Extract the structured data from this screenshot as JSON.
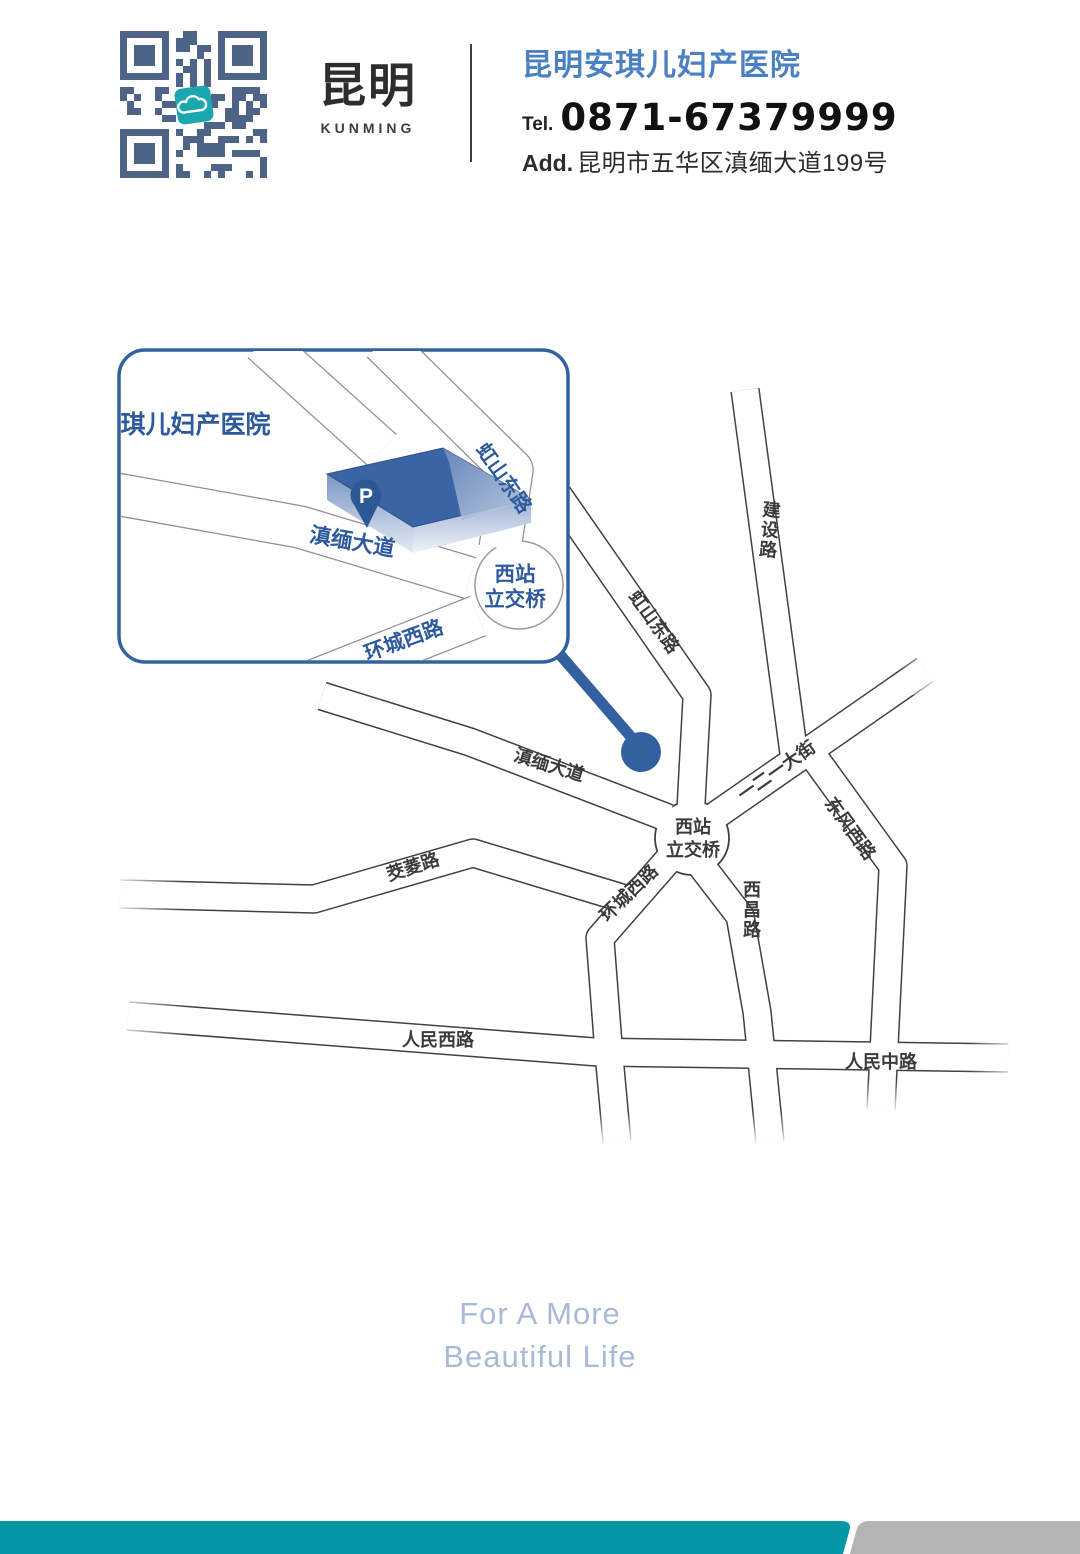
{
  "header": {
    "qr_icon": "qr-code",
    "qr_center_icon": "cloud-logo",
    "brand_cn": "昆明",
    "brand_en": "KUNMING",
    "hospital_name": "昆明安琪儿妇产医院",
    "tel_label": "Tel.",
    "tel_number": "0871-67379999",
    "add_label": "Add.",
    "address": "昆明市五华区滇缅大道199号"
  },
  "inset": {
    "title": "昆明安琪儿妇产医院",
    "parking_mark": "P",
    "roads": {
      "dianmian": "滇缅大道",
      "hongshan": "虹山东路",
      "interchange_1": "西站",
      "interchange_2": "立交桥",
      "huancheng": "环城西路"
    }
  },
  "map": {
    "marker_icon": "location-dot",
    "roads": {
      "jianshe": "建设路",
      "hongshan": "虹山东路",
      "dianmian": "滇缅大道",
      "yieryi": "一二一大街",
      "dongfeng": "东风西路",
      "interchange_1": "西站",
      "interchange_2": "立交桥",
      "huancheng": "环城西路",
      "jiaoling": "茭菱路",
      "xichang": "西昌路",
      "renmin_west": "人民西路",
      "renmin_middle": "人民中路"
    }
  },
  "footer": {
    "slogan_line1": "For A More",
    "slogan_line2": "Beautiful Life"
  },
  "colors": {
    "brand_blue": "#33609f",
    "header_name_blue": "#4b80c2",
    "inset_label_blue": "#2d5a9c",
    "road_line_gray": "#414141",
    "teal_bar": "#0497a6",
    "gray_bar": "#b4b4b4",
    "slogan_blue": "#a9b9d7",
    "qr_module": "#4d6486",
    "qr_center_teal": "#1aa7b0"
  }
}
